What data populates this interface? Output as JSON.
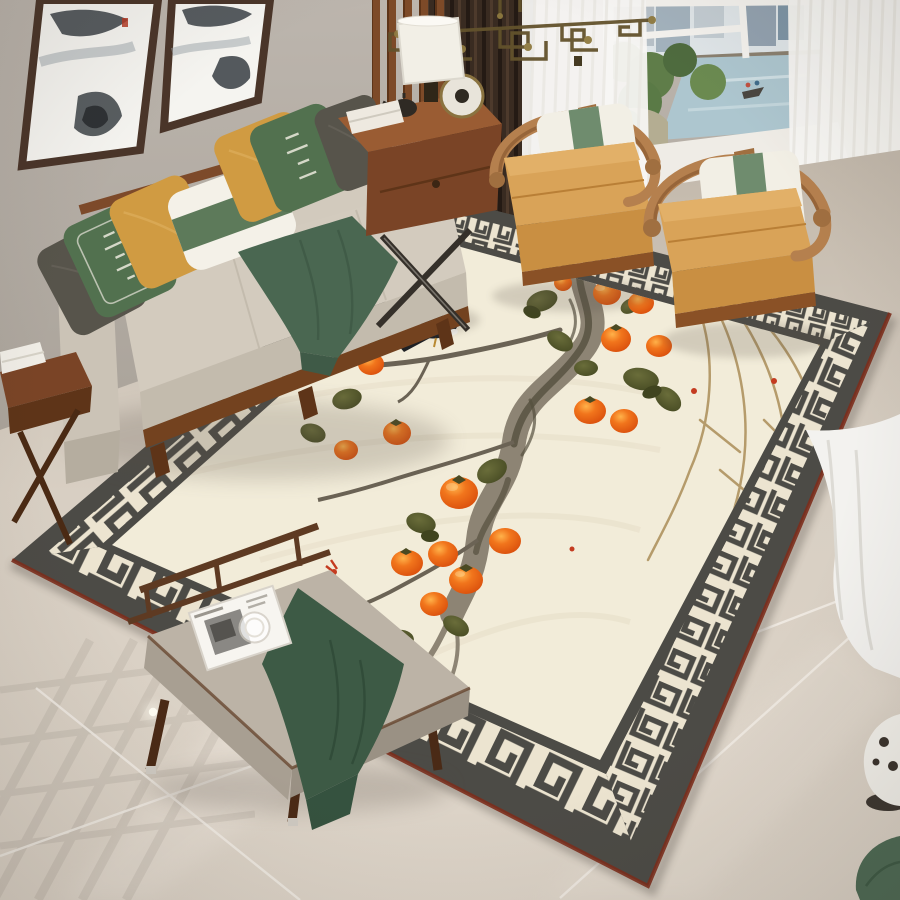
{
  "meta": {
    "title": "New Chinese-style living room with persimmon-motif area rug",
    "kind": "interior photograph, no visible readable text"
  },
  "palette": {
    "wall": "#b6afa7",
    "floor": "#d6ccc0",
    "floor_grout": "#f2ede6",
    "rug_outer": "#4c4b46",
    "rug_edge": "#7c2d1c",
    "rug_meander_bg": "#ece4d0",
    "rug_field": "#f2ecd9",
    "persimmon": "#f1751c",
    "persimmon_deep": "#dd5310",
    "persimmon_light": "#ffb24a",
    "leaf": "#5d6030",
    "leaf_dark": "#40441f",
    "branch": "#8d8474",
    "branch_dark": "#55503f",
    "twig": "#b59b6b",
    "bird_black": "#1f2125",
    "bird_white": "#f4f3ee",
    "bird_beak": "#e8b13c",
    "sofa_wood": "#7d4a2a",
    "sofa_fabric": "#d3cbbe",
    "pillow_gray": "#57544b",
    "pillow_green": "#52714f",
    "pillow_mustard": "#d09b42",
    "pillow_white": "#f4f1e8",
    "band_green": "#5d7a5a",
    "throw_green": "#4a6751",
    "bench_throw": "#3d5a45",
    "bench_wood": "#5e3a22",
    "bench_cushion": "#bcb3a6",
    "chair_wood": "#b5804e",
    "chair_cushion": "#d9a358",
    "chair_cushion_deep": "#c98f42",
    "chair_pillow": "#f2efe5",
    "chair_band": "#6f8c6e",
    "curtain_sheer": "#f7f6f3",
    "curtain_dark": "#392b21",
    "chandelier": "#63522c",
    "window_water": "#adc6cf",
    "window_tree": "#5f7d49",
    "window_building": "#9fb0bb",
    "lamp_shade": "#f2efe6",
    "table_wood": "#7a4426",
    "wall_art_frame": "#4a3529"
  },
  "scene": {
    "wall_art": {
      "count": 2,
      "description": "ink-wash landscape paintings in dark wood frames, red seal mark"
    },
    "chandelier": "bronze geometric fretwork pendant",
    "window": {
      "view": [
        "city buildings",
        "park trees",
        "pond with small boat and bridge"
      ],
      "curtains": [
        "white sheer panels",
        "dark brown striped drape"
      ],
      "sill": "white ledge"
    },
    "sofa": {
      "frame": "walnut wood",
      "upholstery": "light taupe",
      "pillows": [
        "dark gray",
        "green with white calligraphy",
        "mustard",
        "white lumbar with green band",
        "mustard",
        "green with white calligraphy",
        "dark gray"
      ],
      "throw": "green draped over seat"
    },
    "armchairs": {
      "count": 2,
      "style": "horseshoe-back Chinese armchair",
      "cushion": "camel, two tiers",
      "pillow": "white with sage green band"
    },
    "console_table": {
      "items": [
        "white drum-shade lamp",
        "stacked books",
        "bronze disc ornament",
        "dark teapot"
      ]
    },
    "side_table_left": {
      "items": [
        "stack of white books"
      ]
    },
    "bench": {
      "cushion": "warm gray",
      "throw": "dark green draped",
      "tray_items": [
        "black-and-white magazine",
        "glass cup"
      ]
    },
    "rug": {
      "field": "ivory with faint texture",
      "motif": "gnarled persimmon branch, 15 orange persimmons, olive leaves, dry twigs, perched magpie, tiny red buds",
      "border": "greek-key meander band",
      "outer_band": "charcoal",
      "edge_binding": "maroon"
    },
    "floor": "polished beige marble tile with grout lines, lattice reflection and recessed light",
    "corner_objects": [
      "white ceramic stool (partial)",
      "green floor cushion (partial)",
      "pooled sheer curtain hem"
    ]
  }
}
